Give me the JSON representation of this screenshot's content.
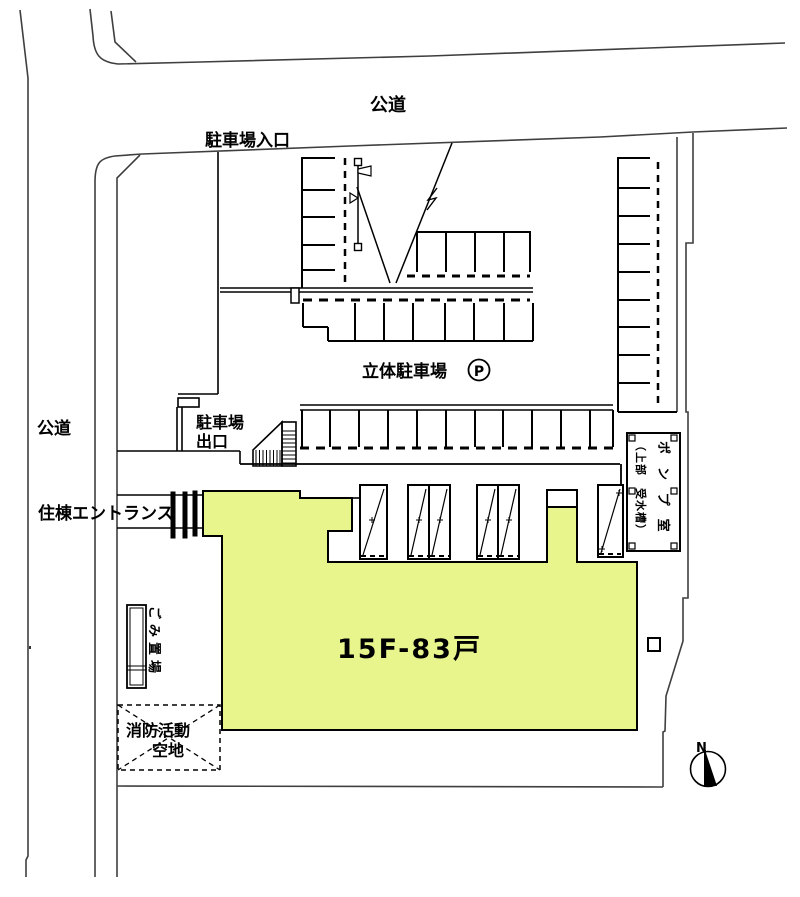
{
  "drawing": {
    "kind": "site-plan",
    "building": {
      "label": "15F-83戸"
    }
  },
  "labels": {
    "road_top": "公道",
    "road_left": "公道",
    "parking_entrance": "駐車場入口",
    "multistory_parking": "立体駐車場",
    "parking_symbol": "P",
    "parking_exit_line1": "駐車場",
    "parking_exit_line2": "出口",
    "residence_entrance": "住棟エントランス",
    "garbage_place": "ごみ置場",
    "fire_activity_line1": "消防活動",
    "fire_activity_line2": "空地",
    "building_main": "15F-83戸",
    "pump_room": "ポンプ室",
    "pump_room_sub": "（上部　受水槽）",
    "north": "N"
  },
  "colors": {
    "building_fill": "#E8F58C",
    "line": "#000000",
    "boundary": "#3F3F3F",
    "background": "#FFFFFF"
  }
}
